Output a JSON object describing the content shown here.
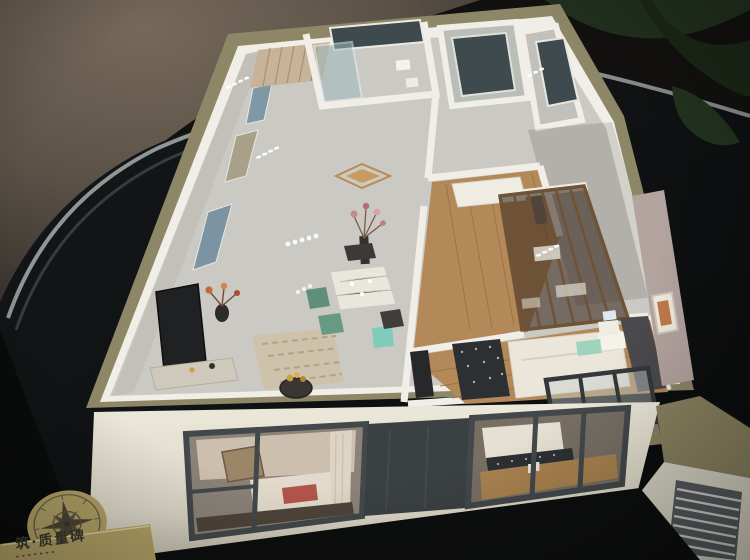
{
  "scene": {
    "subject": "apartment-scale-model-on-dark-table",
    "objects": [
      "display-table",
      "apartment-model",
      "compass-rose-medallion",
      "brand-plaque",
      "potted-plant-leaves"
    ]
  },
  "plaque": {
    "text": "筑·质量碑"
  },
  "palette": {
    "table": "#101213",
    "floor_ambient": "#6a6052",
    "trim": "#a7abac",
    "plant": "#22301e",
    "khaki": "#8e8767",
    "khaki2": "#8a8260",
    "wall_white": "#f0eee6",
    "floor_gray": "#cbc9c3",
    "wall_gray": "#c2c0b9",
    "wood": "#b3895a",
    "cream": "#e7e3d4",
    "slate": "#43484b",
    "glass_dark": "#3e4a4e",
    "bronze": "#6f5336",
    "glass_brown": "#3e2d22",
    "gold": "#b2a166",
    "teal": "#7fccba",
    "mauve": "#b4a4a0",
    "bed_white": "#eae6da",
    "red": "#b2554a",
    "rug_beige": "#cfc2ab",
    "rug_dark": "#2c3033"
  }
}
